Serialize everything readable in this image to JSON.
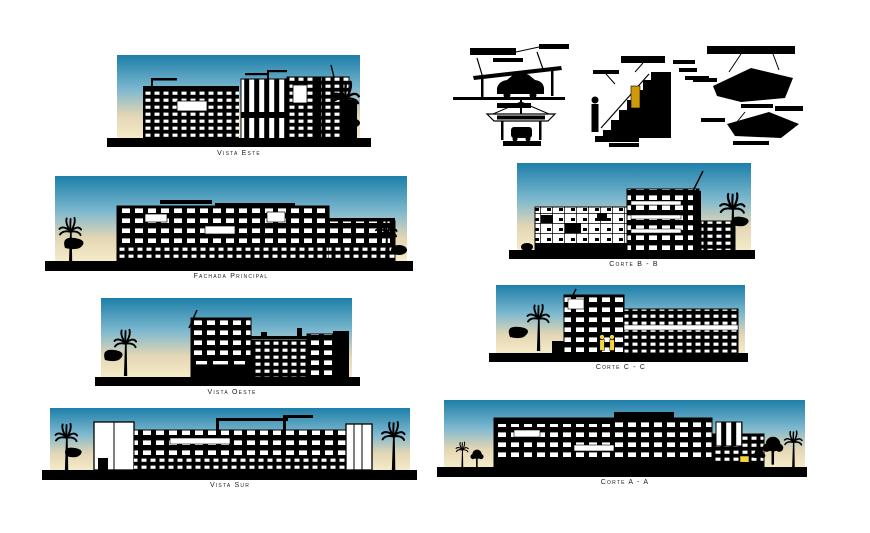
{
  "document": {
    "background": "#ffffff",
    "description_labels_language": "es"
  },
  "colors": {
    "sky_top": "#1d7fa9",
    "sky_mid": "#7fb9cf",
    "sky_horizon": "#e3d6b4",
    "sky_bottom": "#f6ecca",
    "ink": "#000000",
    "label": "#1b1b1b",
    "accent_gold": "#cf9a06",
    "accent_yellow": "#f2d43c"
  },
  "panels": [
    {
      "id": "vista-este",
      "label": "Vista Este"
    },
    {
      "id": "fachada-principal",
      "label": "Fachada Principal"
    },
    {
      "id": "vista-oeste",
      "label": "Vista Oeste"
    },
    {
      "id": "vista-sur",
      "label": "Vista Sur"
    },
    {
      "id": "corte-b-b",
      "label": "Corte B - B"
    },
    {
      "id": "corte-c-c",
      "label": "Corte C - C"
    },
    {
      "id": "corte-a-a",
      "label": "Corte A - A"
    }
  ]
}
